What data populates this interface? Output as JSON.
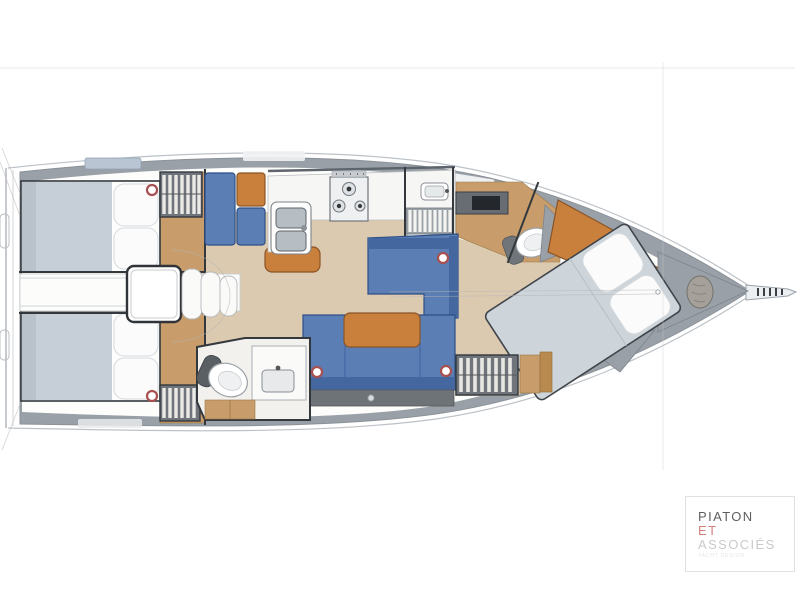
{
  "logo": {
    "line1": "PIATON",
    "line2": "ET",
    "line3": "ASSOCIÉS",
    "tagline": "YACHT DESIGN"
  },
  "colors": {
    "deck_band": "#99a0a7",
    "deck_band_dark": "#5d646b",
    "hull_line": "#8a9197",
    "toe_rail": "#bcc2c7",
    "floor_wood": "#dccab0",
    "cabin_wood": "#c89d6b",
    "furniture_wood": "#c9803d",
    "furniture_wood_dark": "#8a5426",
    "mattress": "#c6cfd7",
    "mattress_shadow": "#b2bcc5",
    "pillow": "#fbfbfb",
    "settee_blue": "#5b7fb4",
    "settee_blue_dark": "#45679f",
    "settee_outline": "#2d4e87",
    "wall_dark": "#33383d",
    "counter_white": "#f6f6f4",
    "sink_gray": "#b6bdc3",
    "locker_gray": "#6e7378",
    "wardrobe_gray": "#6f757b",
    "bow_gray": "#99a0a7",
    "marker_red": "#a85050",
    "logo_dark": "#5f5f60",
    "logo_red": "#d3807d",
    "logo_light": "#cbc9c9",
    "logo_faint": "#e6e3e3"
  }
}
